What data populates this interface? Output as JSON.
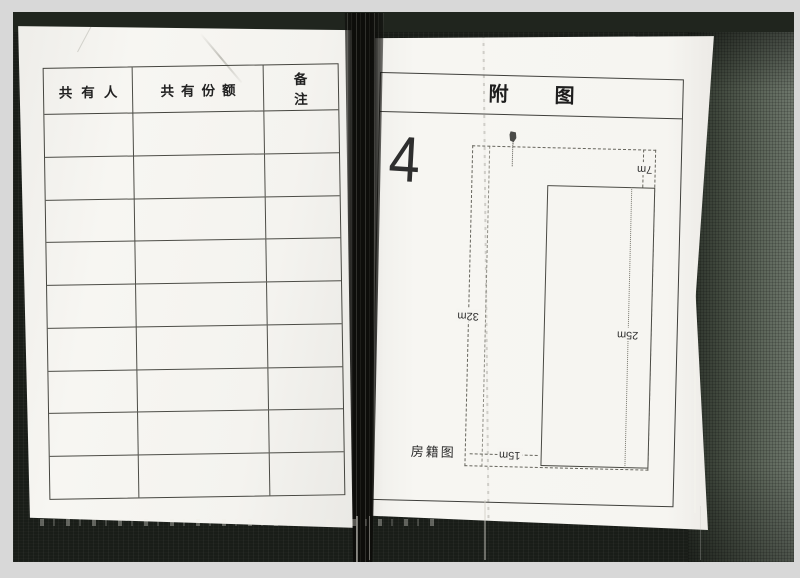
{
  "left_page": {
    "table": {
      "headers": [
        "共有人",
        "共有份额",
        "备注"
      ],
      "row_count": 9,
      "cells_empty": true
    }
  },
  "right_page": {
    "title": "附图",
    "handwritten_number": "4",
    "map_caption": "房籍图",
    "dimensions": {
      "offset_top": "7m",
      "house_depth": "25m",
      "parcel_depth": "32m",
      "parcel_width": "15m"
    }
  },
  "colors": {
    "paper": "#f6f5f1",
    "scan_background": "#191d18",
    "table_line": "#45453f",
    "outer_margin": "#d8d8d8",
    "spine_shadow": "#0d0d0a"
  }
}
